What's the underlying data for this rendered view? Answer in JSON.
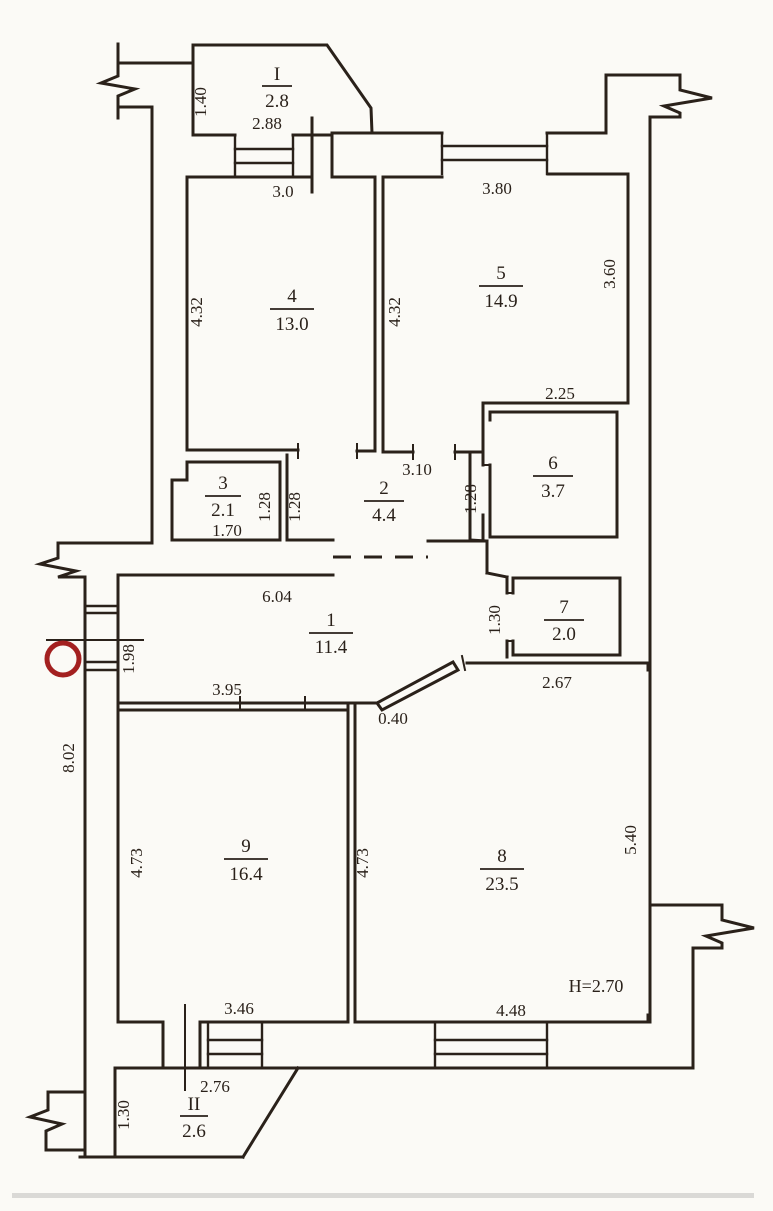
{
  "colors": {
    "line_color": "#2a211a",
    "red_marker": "#a32020",
    "paper": "#fbfaf6"
  },
  "rooms": {
    "r1": {
      "number": "1",
      "area": "11.4"
    },
    "r2": {
      "number": "2",
      "area": "4.4"
    },
    "r3": {
      "number": "3",
      "area": "2.1"
    },
    "r4": {
      "number": "4",
      "area": "13.0"
    },
    "r5": {
      "number": "5",
      "area": "14.9"
    },
    "r6": {
      "number": "6",
      "area": "3.7"
    },
    "r7": {
      "number": "7",
      "area": "2.0"
    },
    "r8": {
      "number": "8",
      "area": "23.5"
    },
    "r9": {
      "number": "9",
      "area": "16.4"
    },
    "balcony1": {
      "number": "I",
      "area": "2.8"
    },
    "balcony2": {
      "number": "II",
      "area": "2.6"
    }
  },
  "dimensions": {
    "balcony1_depth": "1.40",
    "balcony1_width": "2.88",
    "room4_top": "3.0",
    "room4_left": "4.32",
    "room5_left": "4.32",
    "room5_top": "3.80",
    "room5_right": "3.60",
    "room6_top": "2.25",
    "room6_left": "1.28",
    "room2_top": "3.10",
    "room3_right": "1.28",
    "room2_left": "1.28",
    "room3_bottom": "1.70",
    "hall_top": "6.04",
    "hall_window": "1.98",
    "hall_bottom": "3.95",
    "room7_left": "1.30",
    "room8_top": "2.67",
    "door8_width": "0.40",
    "room9_left": "4.73",
    "room8_left": "4.73",
    "room8_right": "5.40",
    "outer_left": "8.02",
    "room9_bottom": "3.46",
    "room8_bottom": "4.48",
    "balcony2_width": "2.76",
    "balcony2_depth": "1.30",
    "ceiling_height": "H=2.70"
  }
}
